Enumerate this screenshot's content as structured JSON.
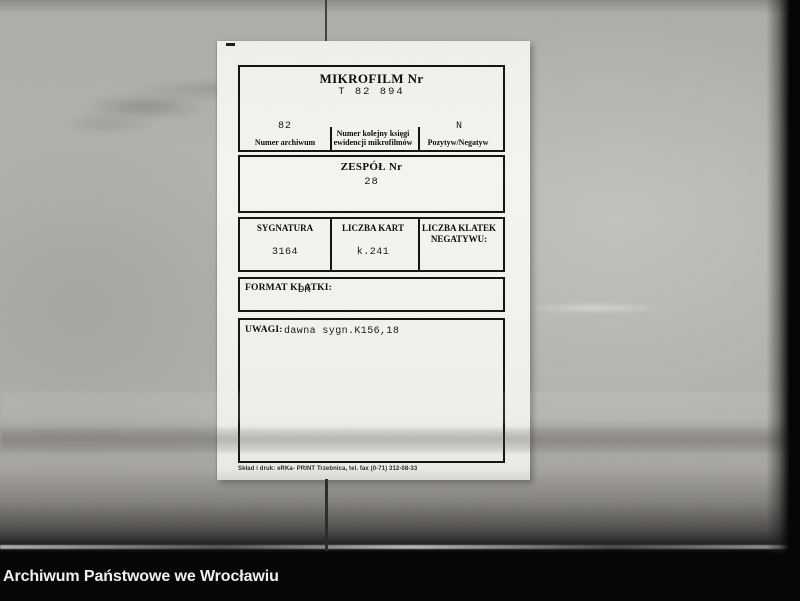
{
  "viewer": {
    "caption": "Archiwum Państwowe we Wrocławiu"
  },
  "card": {
    "header": {
      "title": "MIKROFILM Nr",
      "number": "T 82 894",
      "columns": [
        {
          "value": "82",
          "label": "Numer archiwum"
        },
        {
          "value": "",
          "label_line1": "Numer kolejny księgi",
          "label_line2": "ewidencji mikrofilmów"
        },
        {
          "value": "N",
          "label": "Pozytyw/Negatyw"
        }
      ]
    },
    "zespol": {
      "label": "ZESPÓŁ Nr",
      "value": "28"
    },
    "details": {
      "sygnatura": {
        "label": "SYGNATURA",
        "value": "3164"
      },
      "liczba_kart": {
        "label": "LICZBA KART",
        "value": "k.241"
      },
      "liczba_klatek": {
        "label_line1": "LICZBA KLATEK",
        "label_line2": "NEGATYWU:",
        "value": ""
      }
    },
    "format": {
      "label": "FORMAT KLATKI:",
      "value": "DK"
    },
    "uwagi": {
      "label": "UWAGI:",
      "value": "dawna sygn.K156,18"
    },
    "print_credit": "Skład i druk: eRKa- PRINT Trzebnica, tel. fax (0-71) 312-08-33"
  },
  "colors": {
    "photo_gray": "#b4b2ae",
    "card_white": "#f4f3f0",
    "form_border": "#161514",
    "bar_black": "#060606",
    "caption_text": "#efefef"
  }
}
